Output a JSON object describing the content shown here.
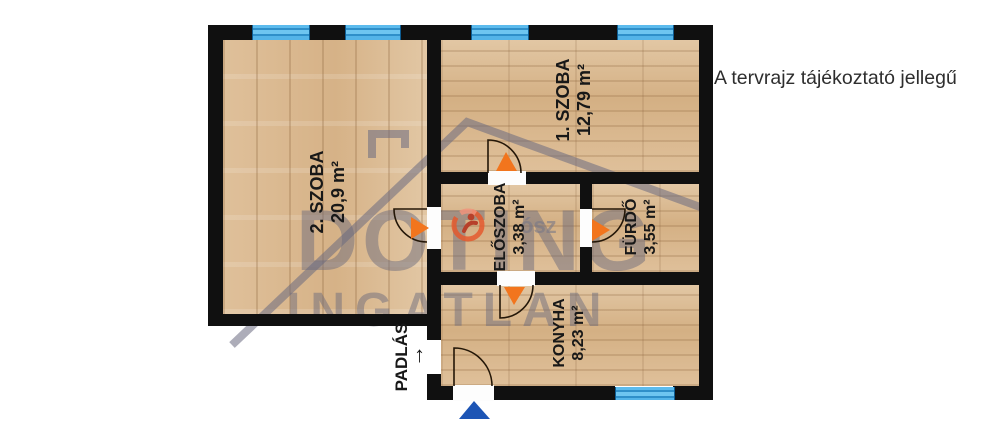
{
  "disclaimer": "A tervrajz tájékoztató jellegű",
  "rooms": [
    {
      "name": "2. SZOBA",
      "area": "20,9 m²"
    },
    {
      "name": "1. SZOBA",
      "area": "12,79 m²"
    },
    {
      "name": "ELŐSZOBA",
      "area": "3,38 m²"
    },
    {
      "name": "FÜRDŐ",
      "area": "3,55 m²"
    },
    {
      "name": "KONYHA",
      "area": "8,23 m²"
    }
  ],
  "attic": {
    "label": "PADLÁS",
    "arrow": "↑"
  },
  "watermark": {
    "line1": "DOTING",
    "line2": "INGATLAN",
    "logo_text": "ósz"
  },
  "colors": {
    "wall": "#101010",
    "floor": "#dcbd97",
    "window_blue": "#45a9e2",
    "door_marker_orange": "#f2751d",
    "entrance_marker_blue": "#1d55b5",
    "watermark_gray": "#6c6c80",
    "disclaimer_text": "#2e2e2e"
  }
}
